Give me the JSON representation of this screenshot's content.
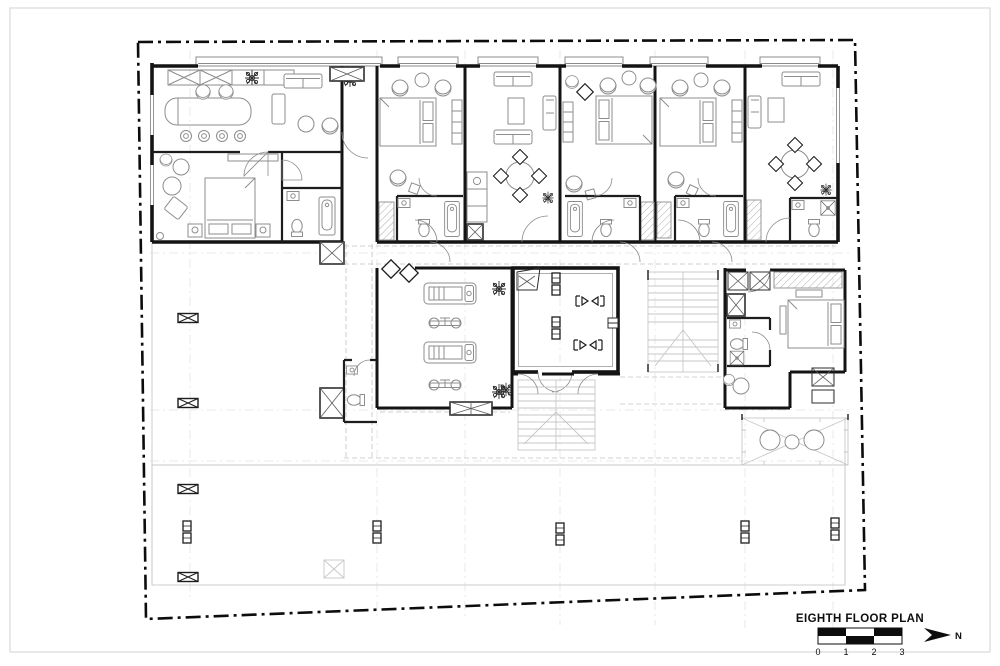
{
  "page": {
    "background": "#ffffff",
    "border_color": "#d9d9d9"
  },
  "title_block": {
    "title": "EIGHTH FLOOR PLAN",
    "scale_labels": [
      "0",
      "1",
      "2",
      "3"
    ],
    "north_label": "N",
    "accent_color": "#0d0d0d"
  }
}
